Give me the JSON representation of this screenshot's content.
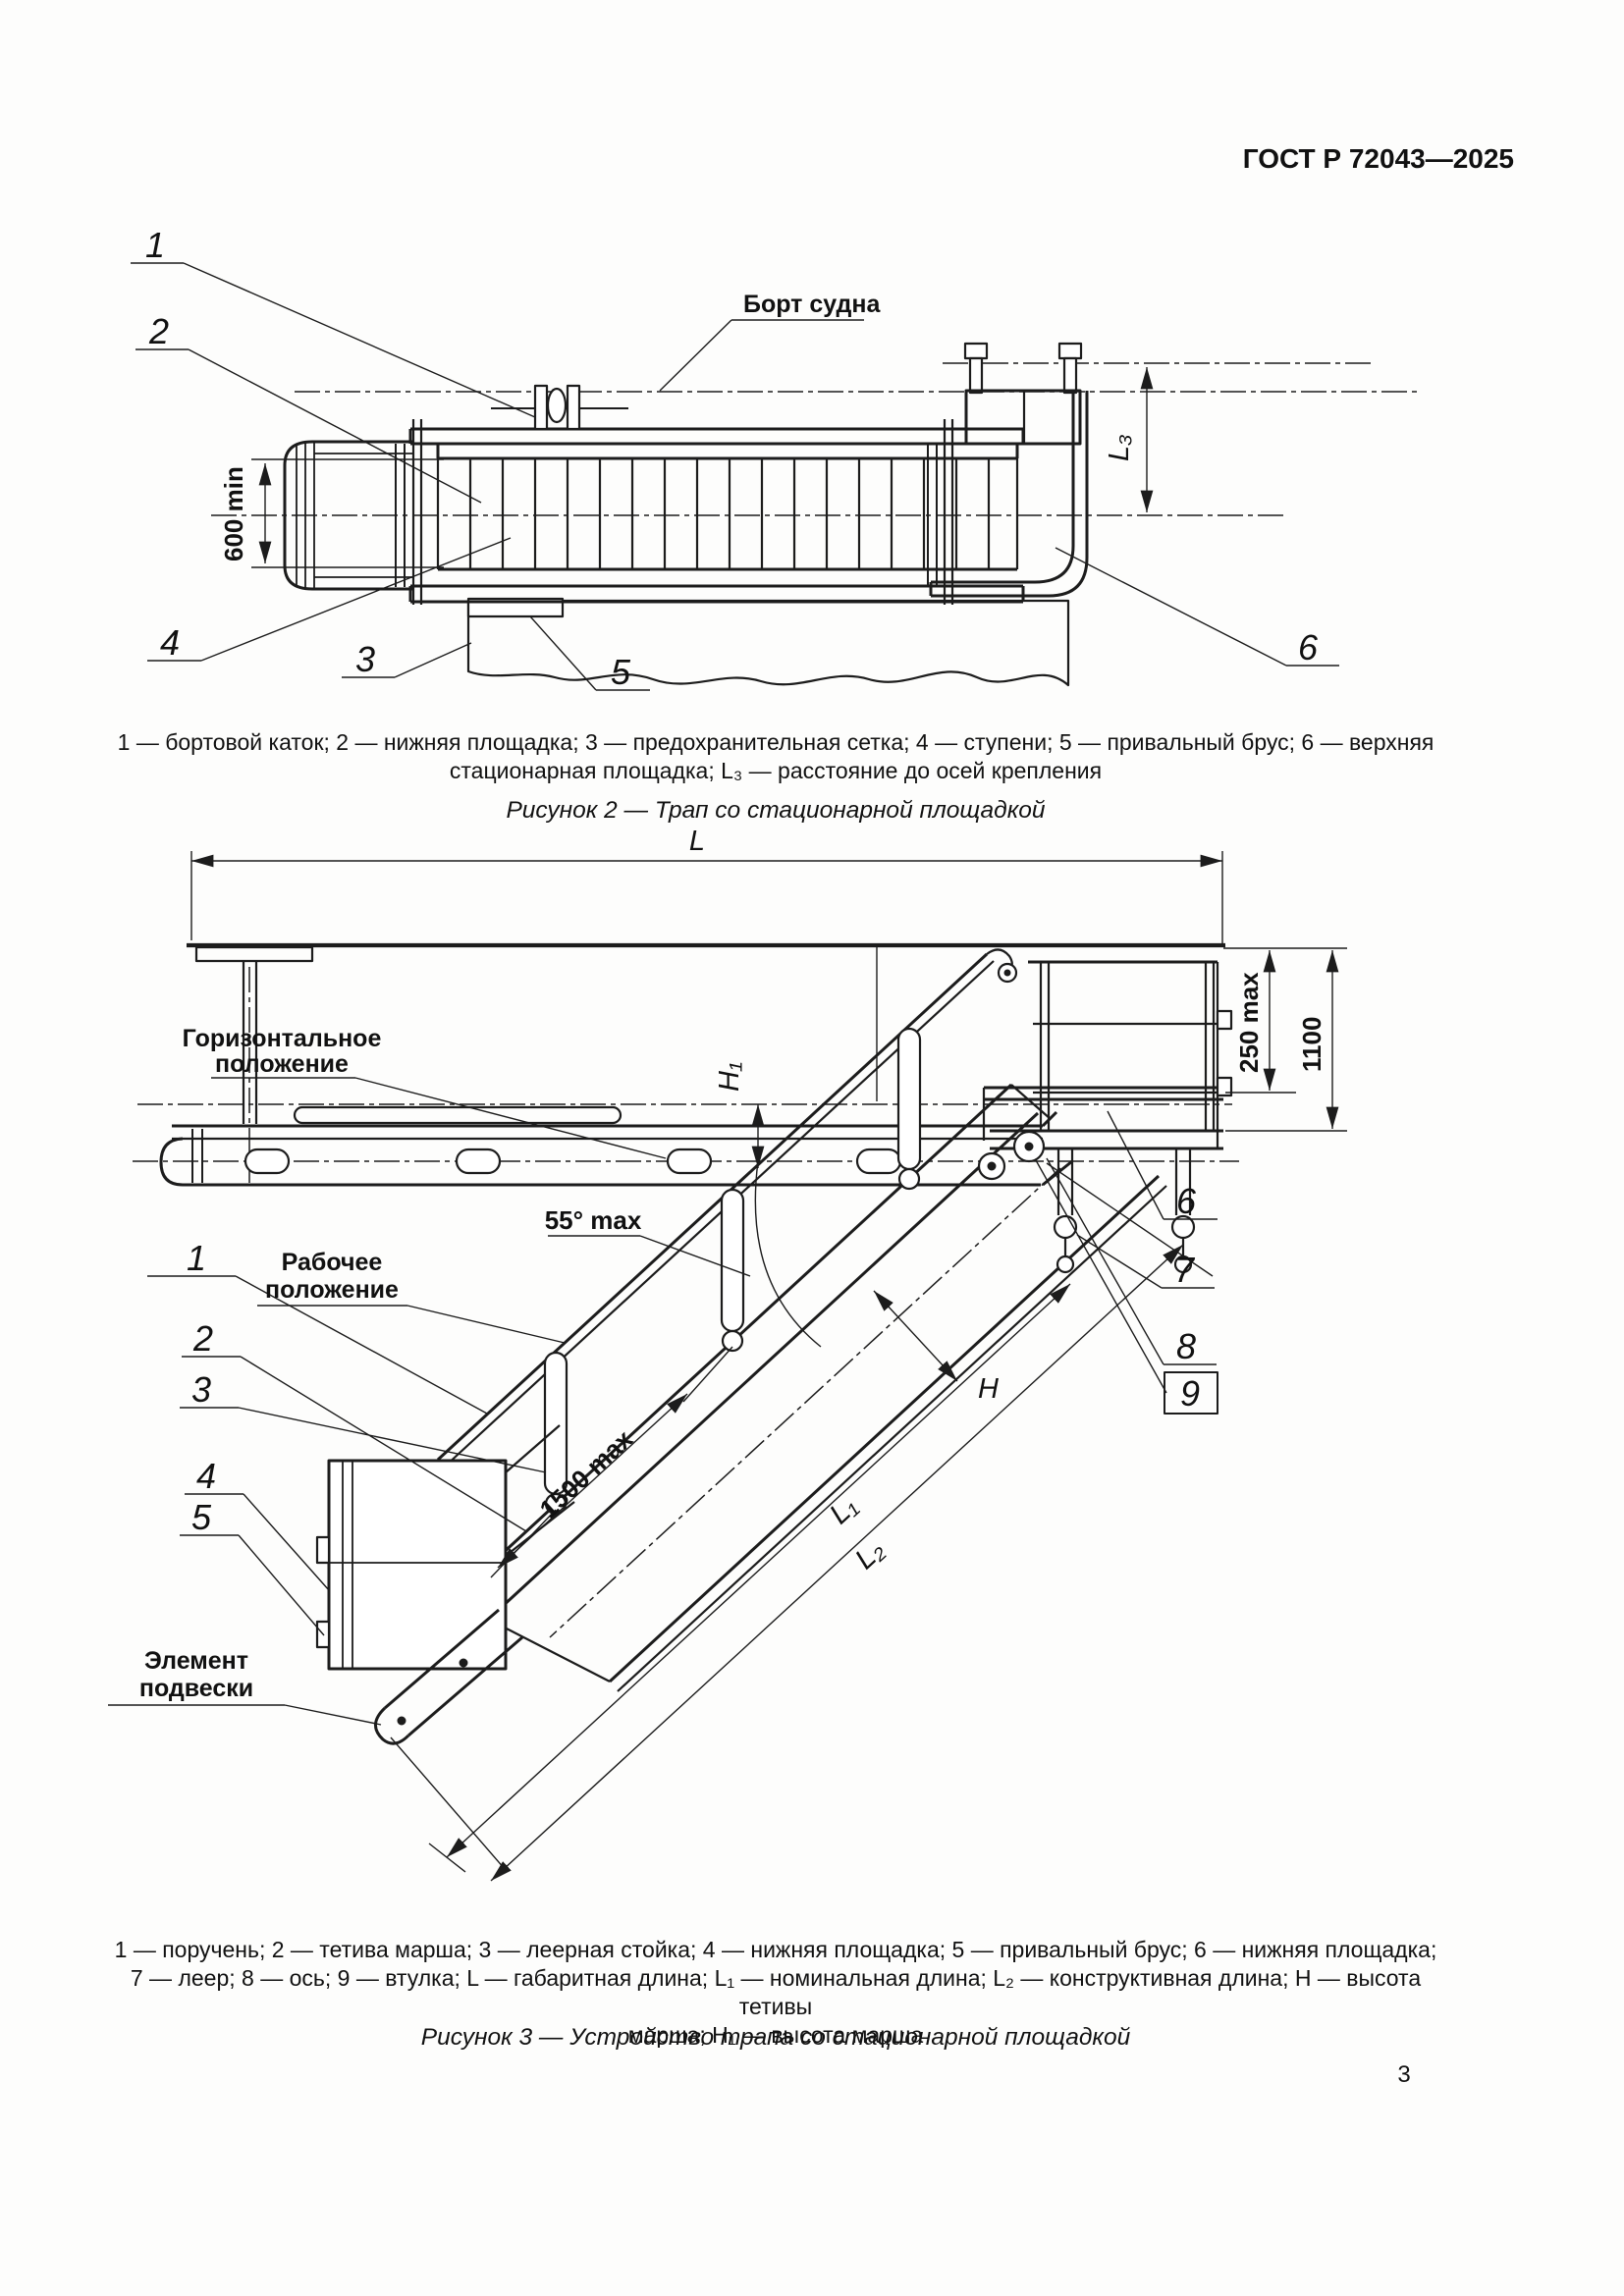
{
  "page": {
    "number": "3"
  },
  "header": {
    "title": "ГОСТ Р 72043—2025"
  },
  "figure2": {
    "callouts": {
      "c1": "1",
      "c2": "2",
      "c3": "3",
      "c4": "4",
      "c5": "5",
      "c6": "6"
    },
    "annotations": {
      "ship_side": "Борт судна"
    },
    "dimensions": {
      "width_min": "600 min",
      "l3": "L₃"
    },
    "legend": {
      "line1": "1 — бортовой каток; 2 — нижняя площадка; 3 — предохранительная сетка; 4 — ступени; 5 — привальный брус; 6 — верхняя",
      "line2": "стационарная площадка; L₃ — расстояние до осей крепления"
    },
    "title": "Рисунок 2 — Трап со стационарной площадкой"
  },
  "figure3": {
    "callouts": {
      "c1": "1",
      "c2": "2",
      "c3": "3",
      "c4": "4",
      "c5": "5",
      "c6": "6",
      "c7": "7",
      "c8": "8",
      "c9": "9"
    },
    "annotations": {
      "horizontal_position": {
        "line1": "Горизонтальное",
        "line2": "положение"
      },
      "working_position": {
        "line1": "Рабочее",
        "line2": "положение"
      },
      "suspension_element": {
        "line1": "Элемент",
        "line2": "подвески"
      }
    },
    "dimensions": {
      "l": "L",
      "l1": "L₁",
      "l2": "L₂",
      "h": "H",
      "h1": "H₁",
      "angle_max": "55° max",
      "step_max": "1500 max",
      "d250": "250 max",
      "d1100": "1100"
    },
    "legend": {
      "line1": "1 — поручень; 2 — тетива марша; 3 — леерная стойка; 4 — нижняя площадка; 5 — привальный брус; 6 — нижняя площадка;",
      "line2": "7 — леер; 8 — ось; 9 — втулка; L — габаритная длина; L₁ — номинальная длина; L₂ — конструктивная длина; H — высота тетивы",
      "line3": "марша; H₁ — высота марша"
    },
    "title": "Рисунок 3 — Устройство трапа со стационарной площадкой"
  }
}
